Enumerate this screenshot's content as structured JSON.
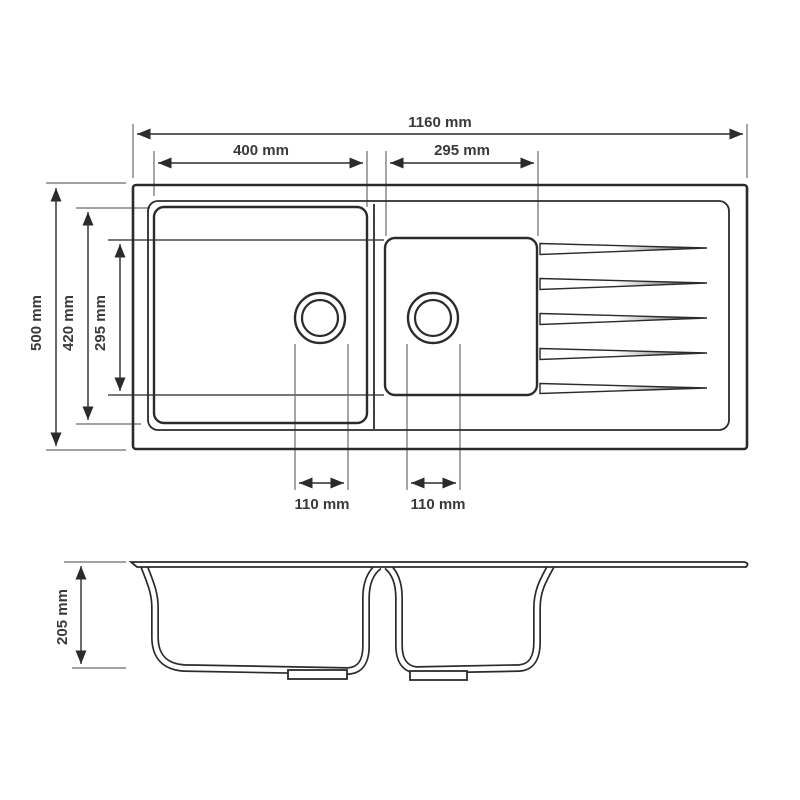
{
  "document": {
    "type": "product-dimension-drawing",
    "subject": "double-bowl kitchen sink with drainer",
    "views": [
      "top-view",
      "side-section-view"
    ],
    "bowl_count": 2,
    "drainer_groove_count": 5,
    "unit": "mm"
  },
  "colors": {
    "background": "#ffffff",
    "line": "#2b2b2b",
    "text": "#3a3a3a",
    "extension_line": "#6b6b6b"
  },
  "top_view": {
    "overall_width_label": "1160 mm",
    "left_bowl_width_label": "400 mm",
    "right_bowl_width_label": "295 mm",
    "overall_depth_label": "500 mm",
    "left_bowl_depth_label": "420 mm",
    "right_bowl_depth_label": "295 mm",
    "left_drain_offset_label": "110 mm",
    "right_drain_offset_label": "110 mm"
  },
  "side_view": {
    "bowl_depth_label": "205 mm"
  }
}
